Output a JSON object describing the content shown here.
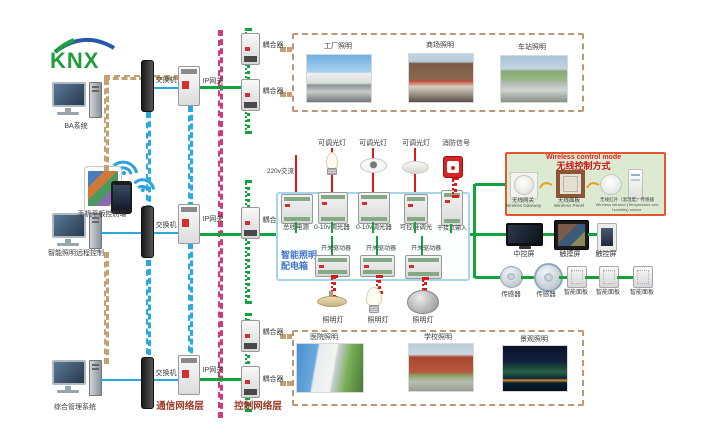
{
  "logo": {
    "text": "KNX"
  },
  "colors": {
    "bus_green": "#0fa53c",
    "ethernet_blue": "#2aa8e0",
    "layer_divider_magenta": "#d03c78",
    "building_tan": "#c2a273",
    "power_red": "#e01818",
    "panel_border_blue": "#a5d5e8",
    "panel_title_blue": "#3f74cc",
    "wireless_border_orange": "#e2572b",
    "wireless_bg_green": "#dcead2",
    "wireless_title_red": "#cc1818"
  },
  "left": {
    "computer_top_label": "BA系统",
    "mobile_label": "手机平板控制端",
    "computer_mid_label": "智能照明远程控制",
    "computer_bottom_label": "综合管理系统"
  },
  "layers": {
    "communication": "通信网络层",
    "control": "控制网络层"
  },
  "network": {
    "switch_label": "交换机",
    "gateway_label": "IP网关",
    "coupler_label": "耦合器"
  },
  "top_gallery": {
    "items": [
      "工厂照明",
      "商场照明",
      "车站照明"
    ]
  },
  "bottom_gallery": {
    "items": [
      "医院照明",
      "学校照明",
      "景观照明"
    ]
  },
  "panel": {
    "title_line1": "智能照明",
    "title_line2": "配电箱",
    "input_label": "220v交流",
    "top_devices": [
      "总线电源",
      "0-10v调光器",
      "0-10v调光器",
      "可控硅调光",
      "干接点输入"
    ],
    "top_loads": [
      "可调光灯",
      "可调光灯",
      "可调光灯",
      "消防信号"
    ],
    "drivers": [
      "开关驱动器",
      "开关驱动器",
      "开关驱动器"
    ],
    "lamps": [
      "照明灯",
      "照明灯",
      "照明灯"
    ]
  },
  "wireless": {
    "title_en": "Wireless control mode",
    "title_zh": "无线控制方式",
    "items": [
      {
        "zh": "无线网关",
        "en": "Wireless Gateway"
      },
      {
        "zh": "无线面板",
        "en": "Wireless Panel"
      },
      {
        "zh": "无线红外（温湿度）传感器",
        "en": "Wireless infrared (Temperature and humidity) sensor"
      }
    ]
  },
  "right": {
    "screens": [
      "中控屏",
      "触摸屏",
      "触控屏"
    ],
    "devices": [
      "传感器",
      "传感器",
      "智能面板",
      "智能面板",
      "智能面板"
    ]
  }
}
